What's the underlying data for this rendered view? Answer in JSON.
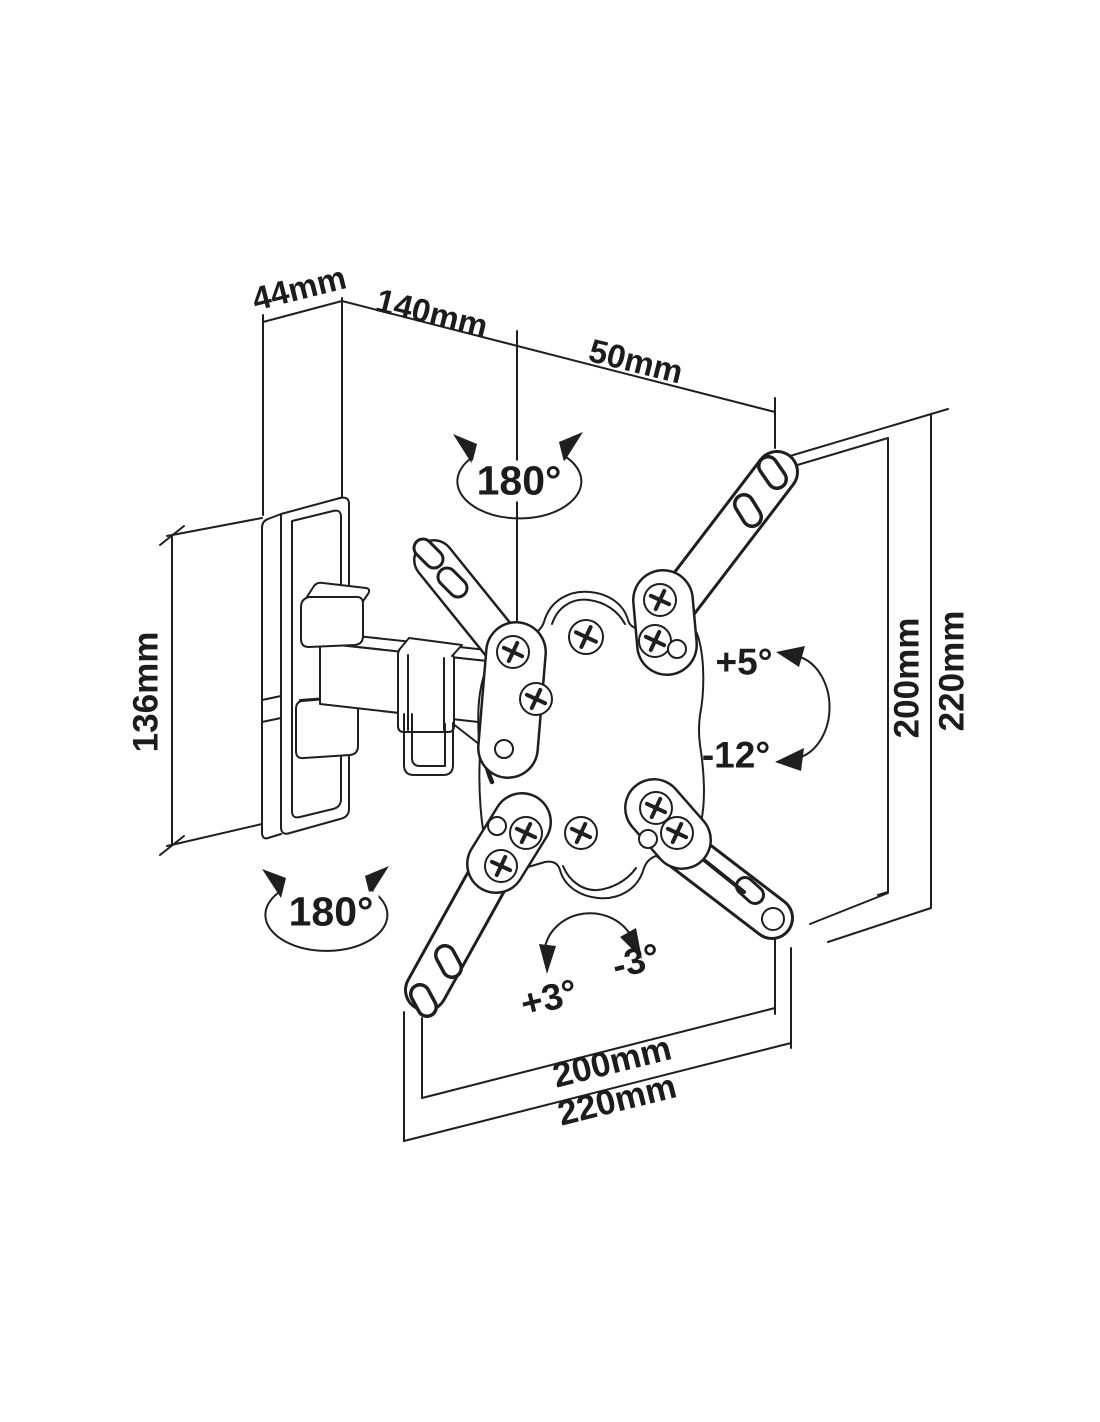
{
  "title": "TV wall mount bracket technical drawing",
  "drawing": {
    "line_color": "#1f1f1f",
    "background": "#ffffff",
    "subject": "Articulating TV wall mount with swivel arm and VESA adapter plate"
  },
  "dimensions": {
    "top": [
      {
        "label": "44mm"
      },
      {
        "label": "140mm"
      },
      {
        "label": "50mm"
      }
    ],
    "left": [
      {
        "label": "136mm"
      }
    ],
    "right": [
      {
        "label": "200mm"
      },
      {
        "label": "220mm"
      }
    ],
    "bottom": [
      {
        "label": "200mm"
      },
      {
        "label": "220mm"
      }
    ]
  },
  "angles": {
    "swivel_top": "180°",
    "swivel_bottom": "180°",
    "tilt_up": "+5°",
    "tilt_down": "-12°",
    "rotate_cw": "+3°",
    "rotate_ccw": "-3°"
  }
}
